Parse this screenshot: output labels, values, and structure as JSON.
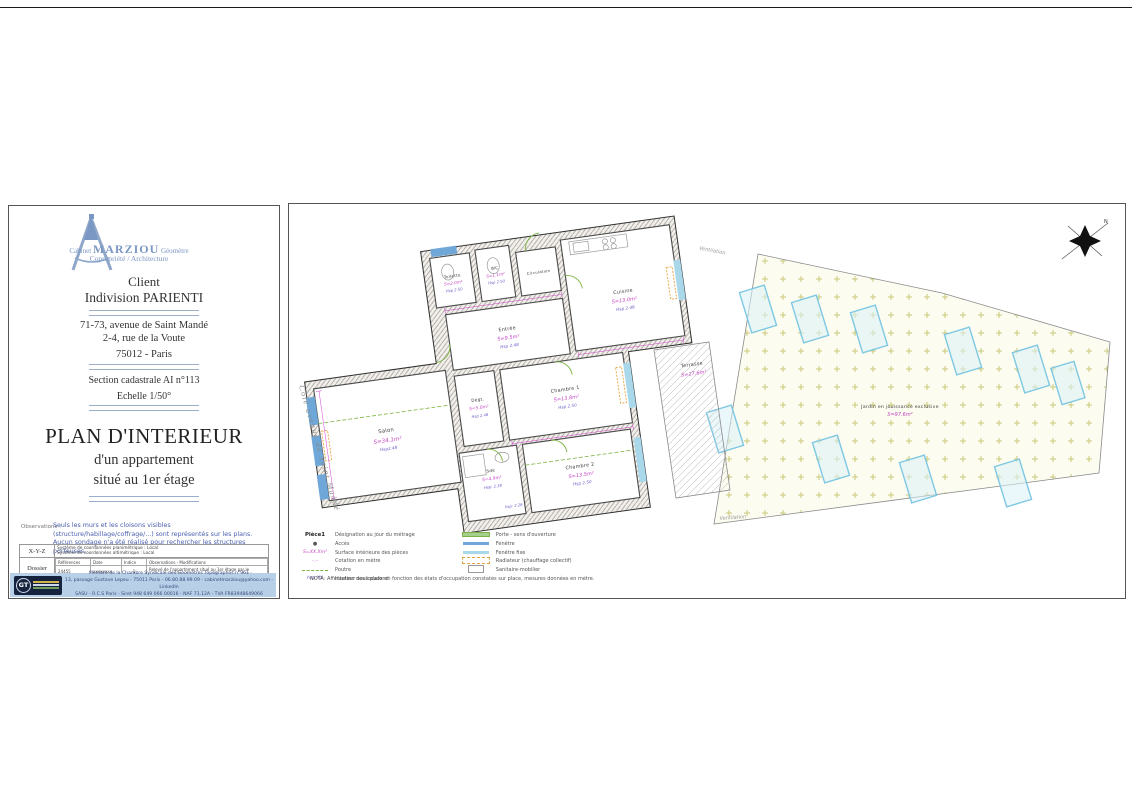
{
  "title_block": {
    "logo": {
      "prefix": "Cabinet",
      "name": "MARZIOU",
      "suffix": "Géomètre",
      "line2": "Copropriété / Architecture"
    },
    "client_label": "Client",
    "client_name": "Indivision PARIENTI",
    "address_line1": "71-73, avenue de Saint Mandé",
    "address_line2": "2-4, rue de la Voute",
    "city": "75012 - Paris",
    "cadastre": "Section cadastrale AI n°113",
    "scale": "Echelle  1/50°",
    "title": "PLAN D'INTERIEUR",
    "subtitle1": "d'un appartement",
    "subtitle2": "situé au 1er étage",
    "observations_label": "Observations :",
    "observations_text": "Seuls les murs et les cloisons visibles (structure/habillage/coffrage/...) sont représentés sur les plans. Aucun sondage n'a été réalisé pour rechercher les structures porteuses.",
    "table": {
      "xyz_label": "X-Y-Z",
      "xyz_line1": "Système de coordonnées planimétrique :   Local",
      "xyz_line2": "Système de coordonnées altimétrique :   Local",
      "dossier_label": "Dossier",
      "headers": [
        "Références",
        "Date",
        "Indice",
        "Observations - Modifications"
      ],
      "row": [
        "24455",
        "xxxxxxxx",
        "1",
        "Relevé de l'appartement situé au 1er étage par le cabinet MARZIOU Géomètre, le 16 septembre 2024"
      ]
    },
    "footer": {
      "line1": "Membre de la Chambre Syndicale des Géomètres Topographes n°961",
      "line2": "13, passage Gustave Lepeu - 75011 Paris - 06.80.88.99.09 - cabinetmarziou@yahoo.com - LinkedIn",
      "line3": "SASU - R.C.S Paris - Siret 948 649 066 00016 - NAF 71.12A - TVA FR83948649066"
    }
  },
  "plan": {
    "street_label": "Côté  avenue  de  Saint  Mandé",
    "ventilation_top": "Ventilation",
    "ventilation_bottom": "Ventilation",
    "compass_north": "N",
    "rooms": {
      "toilette": {
        "name": "Toilette",
        "area": "S=2.0m²",
        "height": "Hsp  2.50"
      },
      "wc": {
        "name": "WC",
        "area": "S=1.1m²",
        "height": "Hsp  2.50"
      },
      "circulation": {
        "name": "Circulation"
      },
      "cuisine": {
        "name": "Cuisine",
        "area": "S=13.0m²",
        "height": "Hsp  2.48"
      },
      "entree": {
        "name": "Entrée",
        "area": "S=9.5m²",
        "height": "Hsp  2.48"
      },
      "chambre1": {
        "name": "Chambre  1",
        "area": "S=13.8m²",
        "height": "Hsp  2.50"
      },
      "salon": {
        "name": "Salon",
        "area": "S=34.1m²",
        "height": "Hsp2.48"
      },
      "degt": {
        "name": "Dégt.",
        "area": "S=5.0m²",
        "height": "Hsp  2.48"
      },
      "sde": {
        "name": "Sde",
        "area": "S=4.9m²",
        "height": "Hsp:  2.38",
        "height2": "hsp:  2.28"
      },
      "chambre2": {
        "name": "Chambre  2",
        "area": "S=13.5m²",
        "height": "Hsp  2.50"
      },
      "terrasse": {
        "name": "Terrasse",
        "area": "S=17.6m²"
      },
      "jardin": {
        "name": "Jardin  en  jouissance  exclusive",
        "area": "S=97.6m²"
      }
    },
    "legend": {
      "title_swatch": "Pièce1",
      "left": [
        {
          "label": "Désignation au jour du métrage"
        },
        {
          "label": "Accès"
        },
        {
          "swatch": "S=XX.Xm²",
          "label": "Surface intérieure des pièces"
        },
        {
          "swatch": "-.--",
          "label": "Cotation en mètre"
        },
        {
          "label": "Poutre"
        },
        {
          "swatch": "hsp XX",
          "label": "Hauteur sous plafond"
        }
      ],
      "right": [
        {
          "label": "Porte - sens d'ouverture"
        },
        {
          "label": "Fenêtre"
        },
        {
          "label": "Fenêtre fixe"
        },
        {
          "label": "Radiateur (chauffage collectif)"
        },
        {
          "label": "Sanitaire-mobilier"
        }
      ],
      "nota": "NOTA: Affectation des locaux en fonction des états d'occupation constatés sur place, mesures données en mètre."
    },
    "colors": {
      "area_magenta": "#c543c5",
      "height_blue": "#6b5fc7",
      "window_blue": "#6fa8d8",
      "fixed_window_cyan": "#a8d8ea",
      "door_green": "#7cb342",
      "radiator_orange": "#e8a33d",
      "footer_band": "#b7cfe7"
    }
  }
}
